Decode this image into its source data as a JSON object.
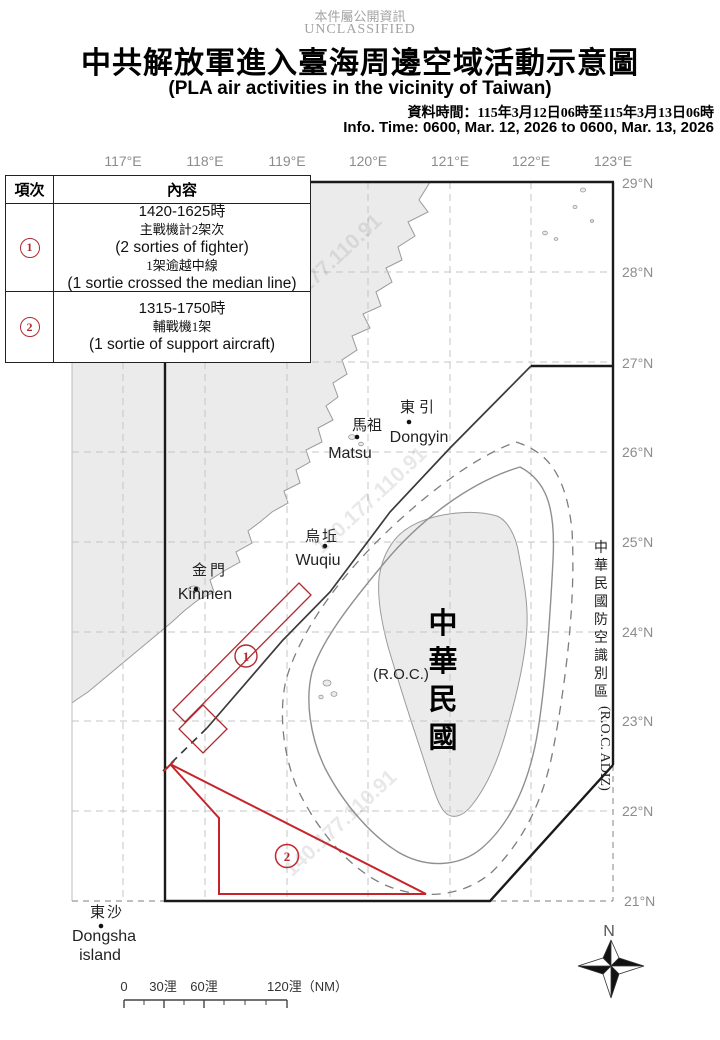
{
  "header": {
    "classification_zh": "本件屬公開資訊",
    "classification_en": "UNCLASSIFIED",
    "title_zh": "中共解放軍進入臺海周邊空域活動示意圖",
    "title_en": "(PLA air activities in the vicinity of Taiwan)",
    "info_time_zh": "資料時間：115年3月12日06時至115年3月13日06時",
    "info_time_en": "Info. Time: 0600, Mar. 12, 2026 to 0600, Mar. 13, 2026"
  },
  "table": {
    "col_item": "項次",
    "col_content": "內容",
    "rows": [
      {
        "symbol": "①",
        "digit": "1",
        "lines": [
          "1420-1625時",
          "主戰機計2架次",
          "(2 sorties of fighter)",
          "1架逾越中線",
          "(1 sortie crossed the median line)"
        ]
      },
      {
        "symbol": "②",
        "digit": "2",
        "lines": [
          "1315-1750時",
          "輔戰機1架",
          "(1 sortie of support aircraft)"
        ]
      }
    ]
  },
  "map": {
    "lon_labels": [
      "117°E",
      "118°E",
      "119°E",
      "120°E",
      "121°E",
      "122°E",
      "123°E"
    ],
    "lat_labels": [
      "29°N",
      "28°N",
      "27°N",
      "26°N",
      "25°N",
      "24°N",
      "23°N",
      "22°N",
      "21°N"
    ],
    "places": {
      "dongyin": {
        "zh": "東引",
        "en": "Dongyin"
      },
      "matsu": {
        "zh": "馬祖",
        "en": "Matsu"
      },
      "wuqiu": {
        "zh": "烏坵",
        "en": "Wuqiu"
      },
      "kinmen": {
        "zh": "金門",
        "en": "Kinmen"
      },
      "dongsha": {
        "zh": "東沙",
        "en": "Dongsha",
        "en2": "island"
      }
    },
    "roc_zh": "中華民國",
    "roc_en": "(R.O.C.)",
    "adiz_zh": "中華民國防空識別區",
    "adiz_en": "(R.O.C. ADIZ)",
    "zones": [
      {
        "symbol": "①",
        "digit": "1"
      },
      {
        "symbol": "②",
        "digit": "2"
      }
    ],
    "compass_n": "N",
    "watermark": "140.177.110.91"
  },
  "scalebar": {
    "labels": [
      "0",
      "30浬",
      "60浬",
      "120浬（NM）"
    ]
  },
  "colors": {
    "zone_red": "#b8272e",
    "land": "#ebebeb",
    "coast": "#9a9a9a",
    "adiz_line": "#1a1a1a",
    "grid": "#c4c4c4",
    "label_gray": "#8c8c8c"
  }
}
